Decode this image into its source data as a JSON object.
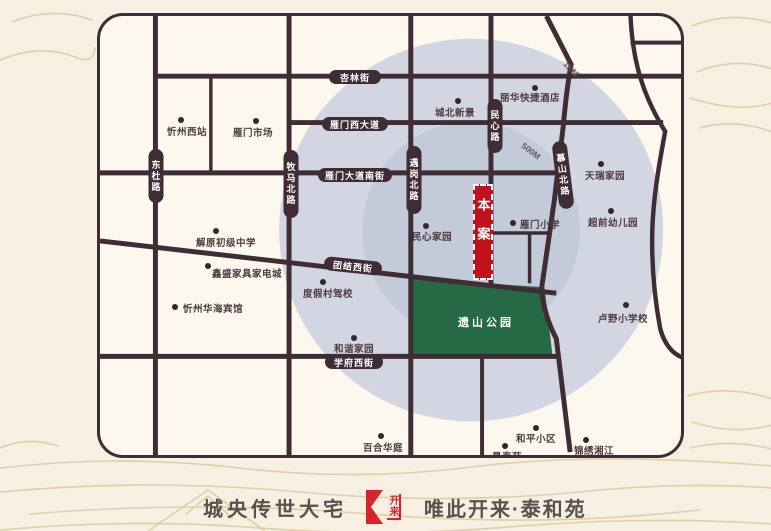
{
  "colors": {
    "page_bg": "#f6efe2",
    "map_bg": "#fcf8ee",
    "road": "#402c34",
    "ring_outer": "#d2d6e3",
    "ring_inner": "#c3cada",
    "park": "#266a45",
    "marker_red": "#c1121c",
    "logo_red": "#d8232a",
    "dot": "#35242b",
    "poi_text": "#4f3b41",
    "ring_label_text": "#6b565c",
    "tagline_text": "#58524f",
    "decor_line": "#dbc89e"
  },
  "map": {
    "rings": {
      "cx": 375,
      "cy": 217,
      "r_outer": 194,
      "r_inner": 110,
      "labels": [
        {
          "text": "1KM",
          "x": 471,
          "y": 53,
          "rot": 47
        },
        {
          "text": "500M",
          "x": 431,
          "y": 135,
          "rot": 38
        }
      ]
    },
    "park": {
      "label": "遗山公园",
      "points": "316,266 449,275 457,343 316,343",
      "label_x": 386,
      "label_y": 306
    },
    "marker": {
      "label": "本案",
      "x": 373,
      "y": 168,
      "w": 20,
      "h": 96
    },
    "roads": [
      {
        "name": "dongdu-road",
        "line": [
          56,
          0,
          56,
          445
        ],
        "w": 5
      },
      {
        "name": "minor-north-road",
        "line": [
          112,
          61,
          112,
          160
        ],
        "w": 3.5
      },
      {
        "name": "muma-north-road",
        "line": [
          191,
          0,
          191,
          445
        ],
        "w": 5
      },
      {
        "name": "yugang-north-road",
        "line": [
          314,
          0,
          314,
          445
        ],
        "w": 5
      },
      {
        "name": "minxin-road",
        "line": [
          395,
          0,
          395,
          274
        ],
        "w": 5
      },
      {
        "name": "south-segment-road",
        "line": [
          386,
          345,
          386,
          445
        ],
        "w": 4
      },
      {
        "name": "mushan-north-road",
        "path": "M451,0 L476,49 C472,70 470,90 468,112 L459,187 L446,277 C448,297 453,312 461,327 L475,442",
        "w": 5
      },
      {
        "name": "east-curve-road",
        "path": "M536,0 C538,45 548,80 571,117 C564,155 559,185 558,217 C557,255 561,290 566,317 C570,332 578,342 588,346",
        "w": 4.5
      },
      {
        "name": "north-east-street",
        "line": [
          536,
          27,
          588,
          27
        ],
        "w": 4
      },
      {
        "name": "xinglin-street",
        "line": [
          56,
          61,
          588,
          61
        ],
        "w": 5
      },
      {
        "name": "yanmen-west-avenue",
        "line": [
          191,
          108,
          569,
          108
        ],
        "w": 5
      },
      {
        "name": "yanmen-avenue-south-street",
        "line": [
          0,
          159,
          464,
          159
        ],
        "w": 5
      },
      {
        "name": "school-block-street",
        "line": [
          395,
          220,
          454,
          220
        ],
        "w": 3.5
      },
      {
        "name": "school-block-cross",
        "line": [
          434,
          220,
          434,
          271
        ],
        "w": 3.5
      },
      {
        "name": "tuanjie-west-street",
        "line": [
          0,
          228,
          461,
          281
        ],
        "w": 5
      },
      {
        "name": "xuefu-west-street",
        "line": [
          0,
          345,
          463,
          345
        ],
        "w": 5
      }
    ],
    "road_labels": [
      {
        "text": "杏林街",
        "cx": 255,
        "cy": 61,
        "w": 52,
        "h": 14
      },
      {
        "text": "雁门西大道",
        "cx": 255,
        "cy": 108,
        "w": 66,
        "h": 14
      },
      {
        "text": "雁门大道南街",
        "cx": 255,
        "cy": 159,
        "w": 74,
        "h": 14
      },
      {
        "text": "团结西街",
        "cx": 253,
        "cy": 250,
        "w": 58,
        "h": 14,
        "rot": 6
      },
      {
        "text": "学府西街",
        "cx": 254,
        "cy": 346,
        "w": 58,
        "h": 14
      },
      {
        "text": "东杜路",
        "cx": 56,
        "cy": 160,
        "w": 15,
        "h": 54,
        "vertical": true
      },
      {
        "text": "牧马北路",
        "cx": 191,
        "cy": 168,
        "w": 15,
        "h": 68,
        "vertical": true
      },
      {
        "text": "遇岗北路",
        "cx": 314,
        "cy": 164,
        "w": 15,
        "h": 68,
        "vertical": true
      },
      {
        "text": "民心路",
        "cx": 395,
        "cy": 110,
        "w": 15,
        "h": 54,
        "vertical": true
      },
      {
        "text": "慕山北路",
        "cx": 463,
        "cy": 159,
        "w": 15,
        "h": 68,
        "vertical": true,
        "rot": -7
      }
    ],
    "pois": [
      {
        "text": "忻州西站",
        "dot": [
          81,
          104
        ],
        "label": [
          87,
          115
        ]
      },
      {
        "text": "雁门市场",
        "dot": [
          156,
          105
        ],
        "label": [
          153,
          116
        ]
      },
      {
        "text": "城北新景",
        "dot": [
          358,
          85
        ],
        "label": [
          355,
          96
        ]
      },
      {
        "text": "丽华快捷酒店",
        "dot": [
          435,
          72
        ],
        "label": [
          430,
          81
        ]
      },
      {
        "text": "天瑞家园",
        "dot": [
          501,
          148
        ],
        "label": [
          505,
          159
        ]
      },
      {
        "text": "超前幼儿园",
        "dot": [
          511,
          195
        ],
        "label": [
          513,
          206
        ]
      },
      {
        "text": "雁门小学",
        "dot": [
          413,
          207
        ],
        "label": [
          440,
          208
        ]
      },
      {
        "text": "民心家园",
        "dot": [
          326,
          210
        ],
        "label": [
          332,
          220
        ]
      },
      {
        "text": "解原初级中学",
        "dot": [
          116,
          215
        ],
        "label": [
          126,
          226
        ]
      },
      {
        "text": "鑫盛家具家电城",
        "dot": [
          108,
          250
        ],
        "label": [
          147,
          257
        ]
      },
      {
        "text": "度假村驾校",
        "dot": [
          223,
          266
        ],
        "label": [
          228,
          277
        ]
      },
      {
        "text": "忻州华海宾馆",
        "dot": [
          75,
          291
        ],
        "label": [
          113,
          292
        ]
      },
      {
        "text": "和谐家园",
        "dot": [
          254,
          322
        ],
        "label": [
          254,
          332
        ]
      },
      {
        "text": "卢野小学校",
        "dot": [
          526,
          289
        ],
        "label": [
          523,
          302
        ]
      },
      {
        "text": "百合华庭",
        "dot": [
          281,
          420
        ],
        "label": [
          283,
          431
        ]
      },
      {
        "text": "景泰苑",
        "dot": [
          405,
          430
        ],
        "label": [
          407,
          440
        ]
      },
      {
        "text": "和平小区",
        "dot": [
          436,
          412
        ],
        "label": [
          436,
          422
        ]
      },
      {
        "text": "锦绣湘江",
        "dot": [
          486,
          424
        ],
        "label": [
          494,
          434
        ]
      }
    ]
  },
  "tagline": {
    "left": "城央传世大宅",
    "right": "唯此开来·泰和苑",
    "logo_text": "开来"
  }
}
